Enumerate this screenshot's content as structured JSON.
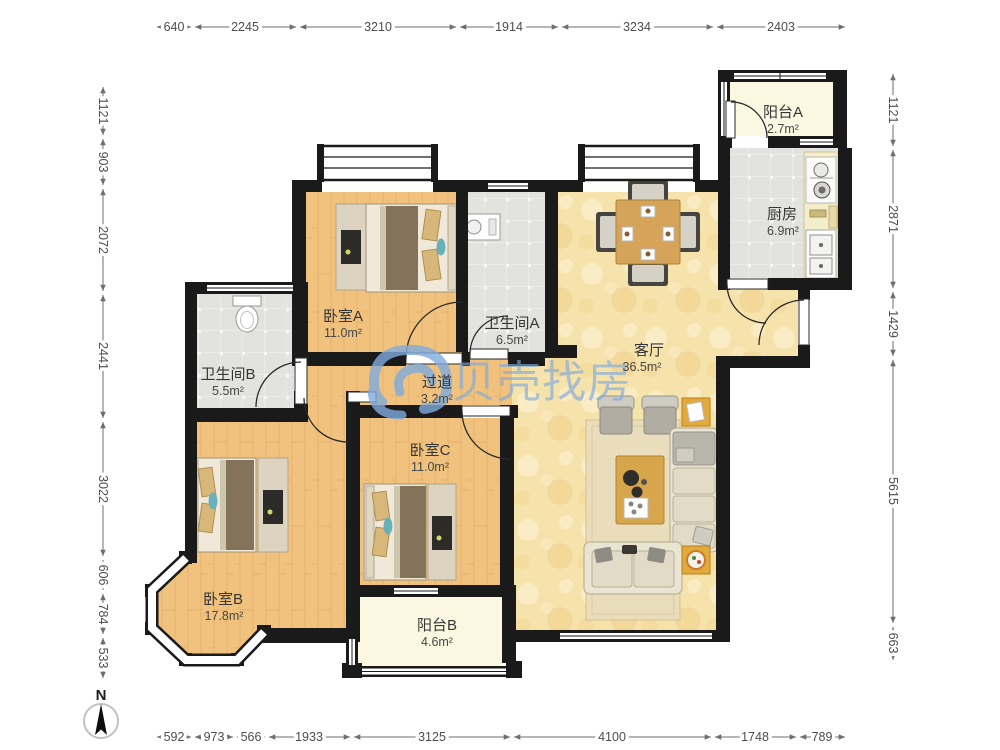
{
  "app": {
    "type": "floorplan-viewer",
    "watermark_brand": "贝壳找房"
  },
  "watermark": {
    "text": "贝壳找房",
    "logo": "beike-house-logo",
    "color": "#7fabdf"
  },
  "compass": {
    "label": "N"
  },
  "rooms": [
    {
      "id": "balcony-a",
      "name": "阳台A",
      "area": "2.7m²"
    },
    {
      "id": "kitchen",
      "name": "厨房",
      "area": "6.9m²"
    },
    {
      "id": "bedroom-a",
      "name": "卧室A",
      "area": "11.0m²"
    },
    {
      "id": "bathroom-a",
      "name": "卫生间A",
      "area": "6.5m²"
    },
    {
      "id": "bathroom-b",
      "name": "卫生间B",
      "area": "5.5m²"
    },
    {
      "id": "hallway",
      "name": "过道",
      "area": "3.2m²"
    },
    {
      "id": "living-room",
      "name": "客厅",
      "area": "36.5m²"
    },
    {
      "id": "bedroom-c",
      "name": "卧室C",
      "area": "11.0m²"
    },
    {
      "id": "bedroom-b",
      "name": "卧室B",
      "area": "17.8m²"
    },
    {
      "id": "balcony-b",
      "name": "阳台B",
      "area": "4.6m²"
    }
  ],
  "dimensions": {
    "top": [
      "640",
      "2245",
      "3210",
      "1914",
      "3234",
      "2403"
    ],
    "bottom": [
      "592",
      "973",
      "566",
      "1933",
      "3125",
      "4100",
      "1748",
      "789"
    ],
    "left": [
      "1121",
      "903",
      "2072",
      "2441",
      "3022",
      "606",
      "784",
      "533"
    ],
    "right": [
      "1121",
      "2871",
      "1429",
      "5615",
      "663"
    ]
  },
  "colors": {
    "wall": "#1a1a1a",
    "wood_floor": "#f0c27e",
    "tile_floor": "#e2e3df",
    "living_floor": "#f6e3ac",
    "balcony_floor": "#fbf7e1",
    "watermark_blue": "#7fabdf",
    "accent_teal": "#68b1ba",
    "furniture_wood": "#d6a458"
  }
}
